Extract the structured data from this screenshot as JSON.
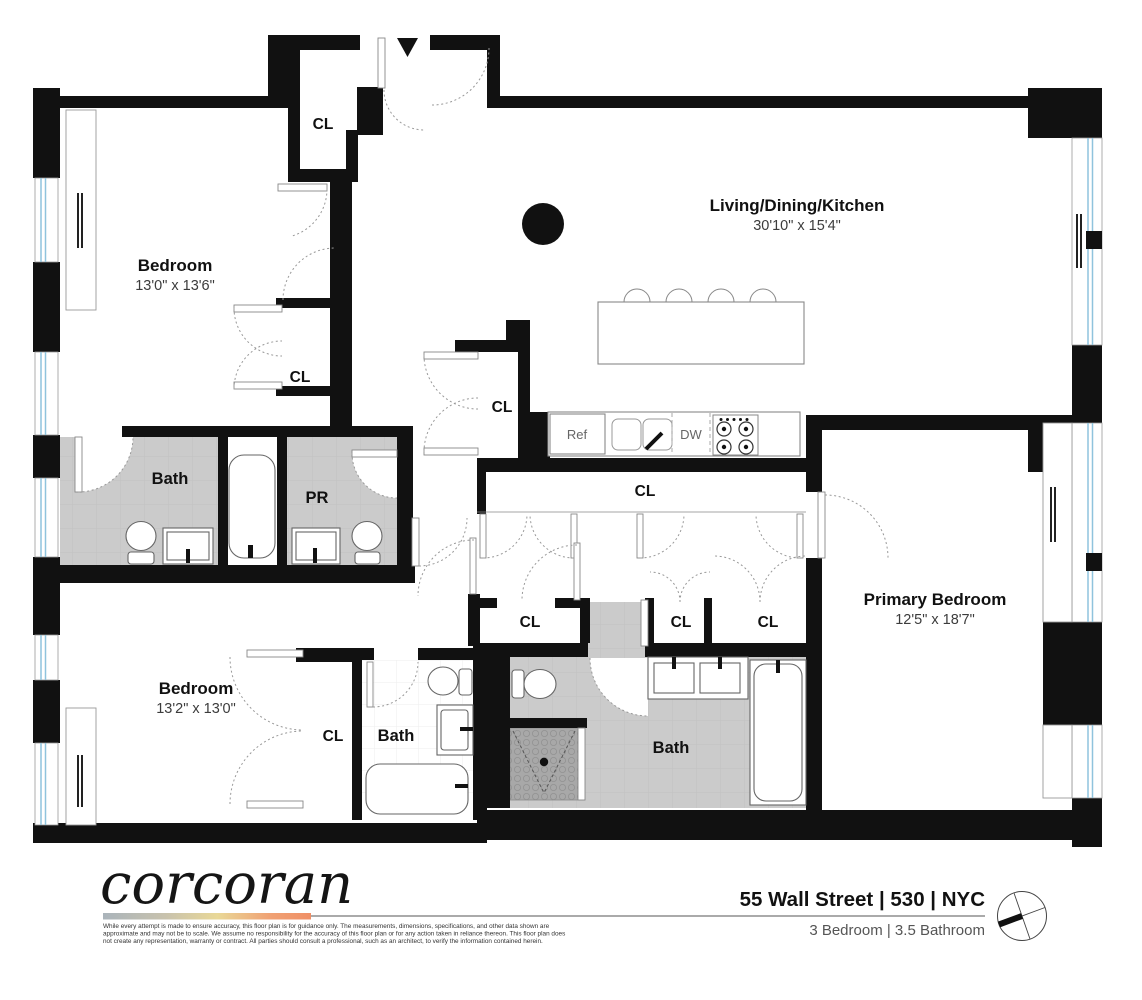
{
  "plan": {
    "rooms": [
      {
        "name": "Bedroom",
        "dims": "13'0\" x 13'6\""
      },
      {
        "name": "Living/Dining/Kitchen",
        "dims": "30'10\" x 15'4\""
      },
      {
        "name": "Primary Bedroom",
        "dims": "12'5\" x 18'7\""
      },
      {
        "name": "Bedroom",
        "dims": "13'2\" x 13'0\""
      }
    ],
    "bath_labels": [
      "Bath",
      "PR",
      "Bath",
      "Bath"
    ],
    "closet_label": "CL",
    "appliances": {
      "refrigerator": "Ref",
      "dishwasher": "DW"
    }
  },
  "footer": {
    "brand": "corcoran",
    "address": "55 Wall Street | 530 | NYC",
    "summary": "3 Bedroom | 3.5 Bathroom",
    "disclaimer": [
      "While every attempt is made to ensure accuracy, this floor plan is for guidance only. The measurements, dimensions, specifications, and other data shown are",
      "approximate and may not be to scale. We assume no responsibility for the accuracy of this floor plan or for any action taken in reliance thereon. This floor plan does",
      "not create any representation, warranty or contract. All parties should consult a professional, such as an architect, to verify the information contained herein."
    ]
  },
  "colors": {
    "wall": "#111111",
    "bath_floor": "#cbcbcb",
    "shower_floor": "#a8a8a8",
    "window_glass": "#8fc3dd",
    "brand_bar": [
      "#aab4bb",
      "#c8c2ad",
      "#e9d897",
      "#f0a274",
      "#f08f66"
    ]
  }
}
